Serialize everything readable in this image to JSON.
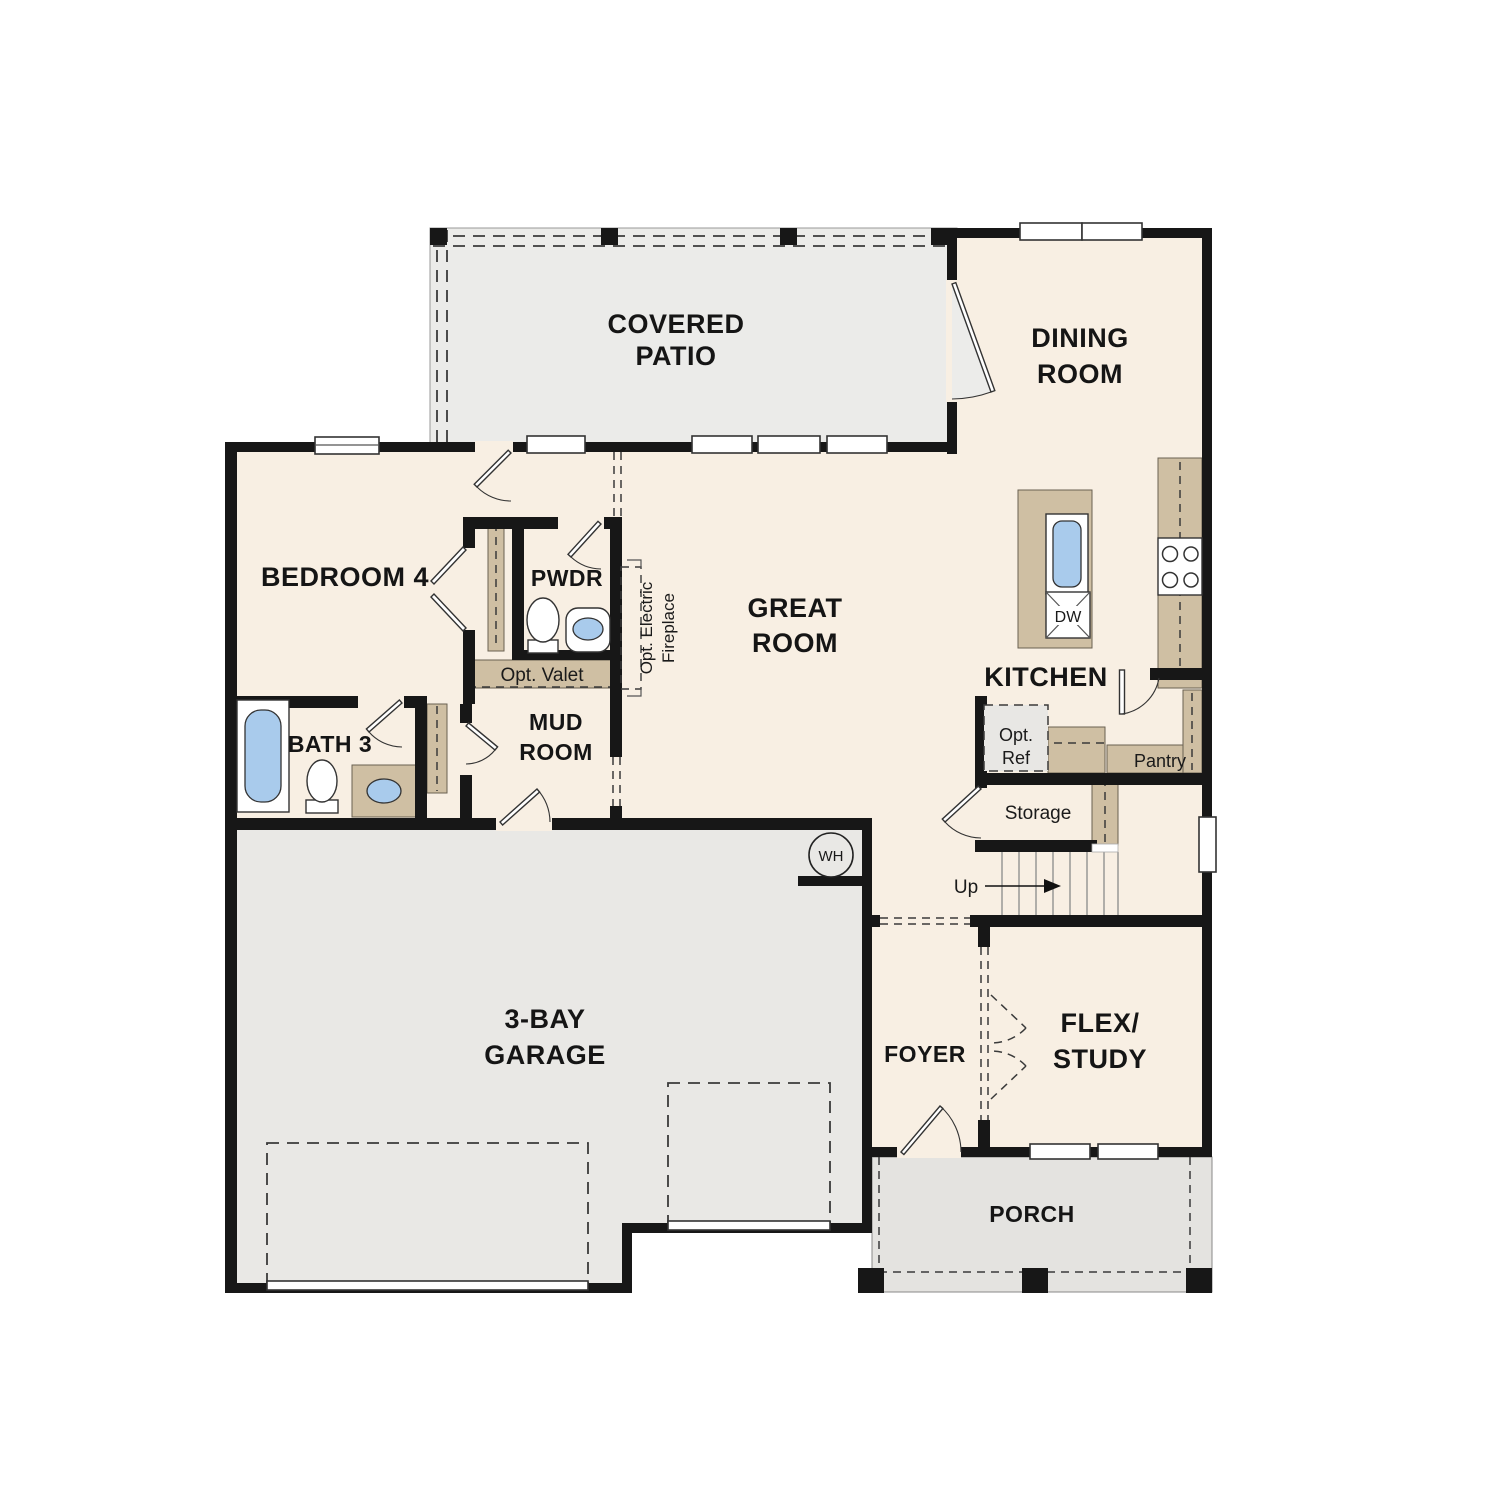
{
  "colors": {
    "wall": "#171717",
    "interior_floor": "#f8efe3",
    "patio_floor": "#ebebe9",
    "garage_floor": "#e9e8e5",
    "porch_floor": "#e4e3e0",
    "cabinet_tan": "#cfbfa3",
    "fixture_blue": "#a9cbec"
  },
  "rooms": {
    "covered_patio": {
      "line1": "COVERED",
      "line2": "PATIO"
    },
    "dining": {
      "line1": "DINING",
      "line2": "ROOM"
    },
    "bedroom4": {
      "label": "BEDROOM 4"
    },
    "pwdr": {
      "label": "PWDR"
    },
    "great_room": {
      "line1": "GREAT",
      "line2": "ROOM"
    },
    "kitchen": {
      "label": "KITCHEN"
    },
    "mud_room": {
      "line1": "MUD",
      "line2": "ROOM"
    },
    "bath3": {
      "label": "BATH 3"
    },
    "storage": {
      "label": "Storage"
    },
    "pantry": {
      "label": "Pantry"
    },
    "garage": {
      "line1": "3-BAY",
      "line2": "GARAGE"
    },
    "foyer": {
      "label": "FOYER"
    },
    "flex_study": {
      "line1": "FLEX/",
      "line2": "STUDY"
    },
    "porch": {
      "label": "PORCH"
    }
  },
  "features": {
    "opt_valet": "Opt. Valet",
    "opt_electric_fireplace": {
      "line1": "Opt. Electric",
      "line2": "Fireplace"
    },
    "opt_ref": {
      "line1": "Opt.",
      "line2": "Ref"
    },
    "stairs_up": "Up",
    "water_heater": "WH",
    "dishwasher": "DW"
  }
}
